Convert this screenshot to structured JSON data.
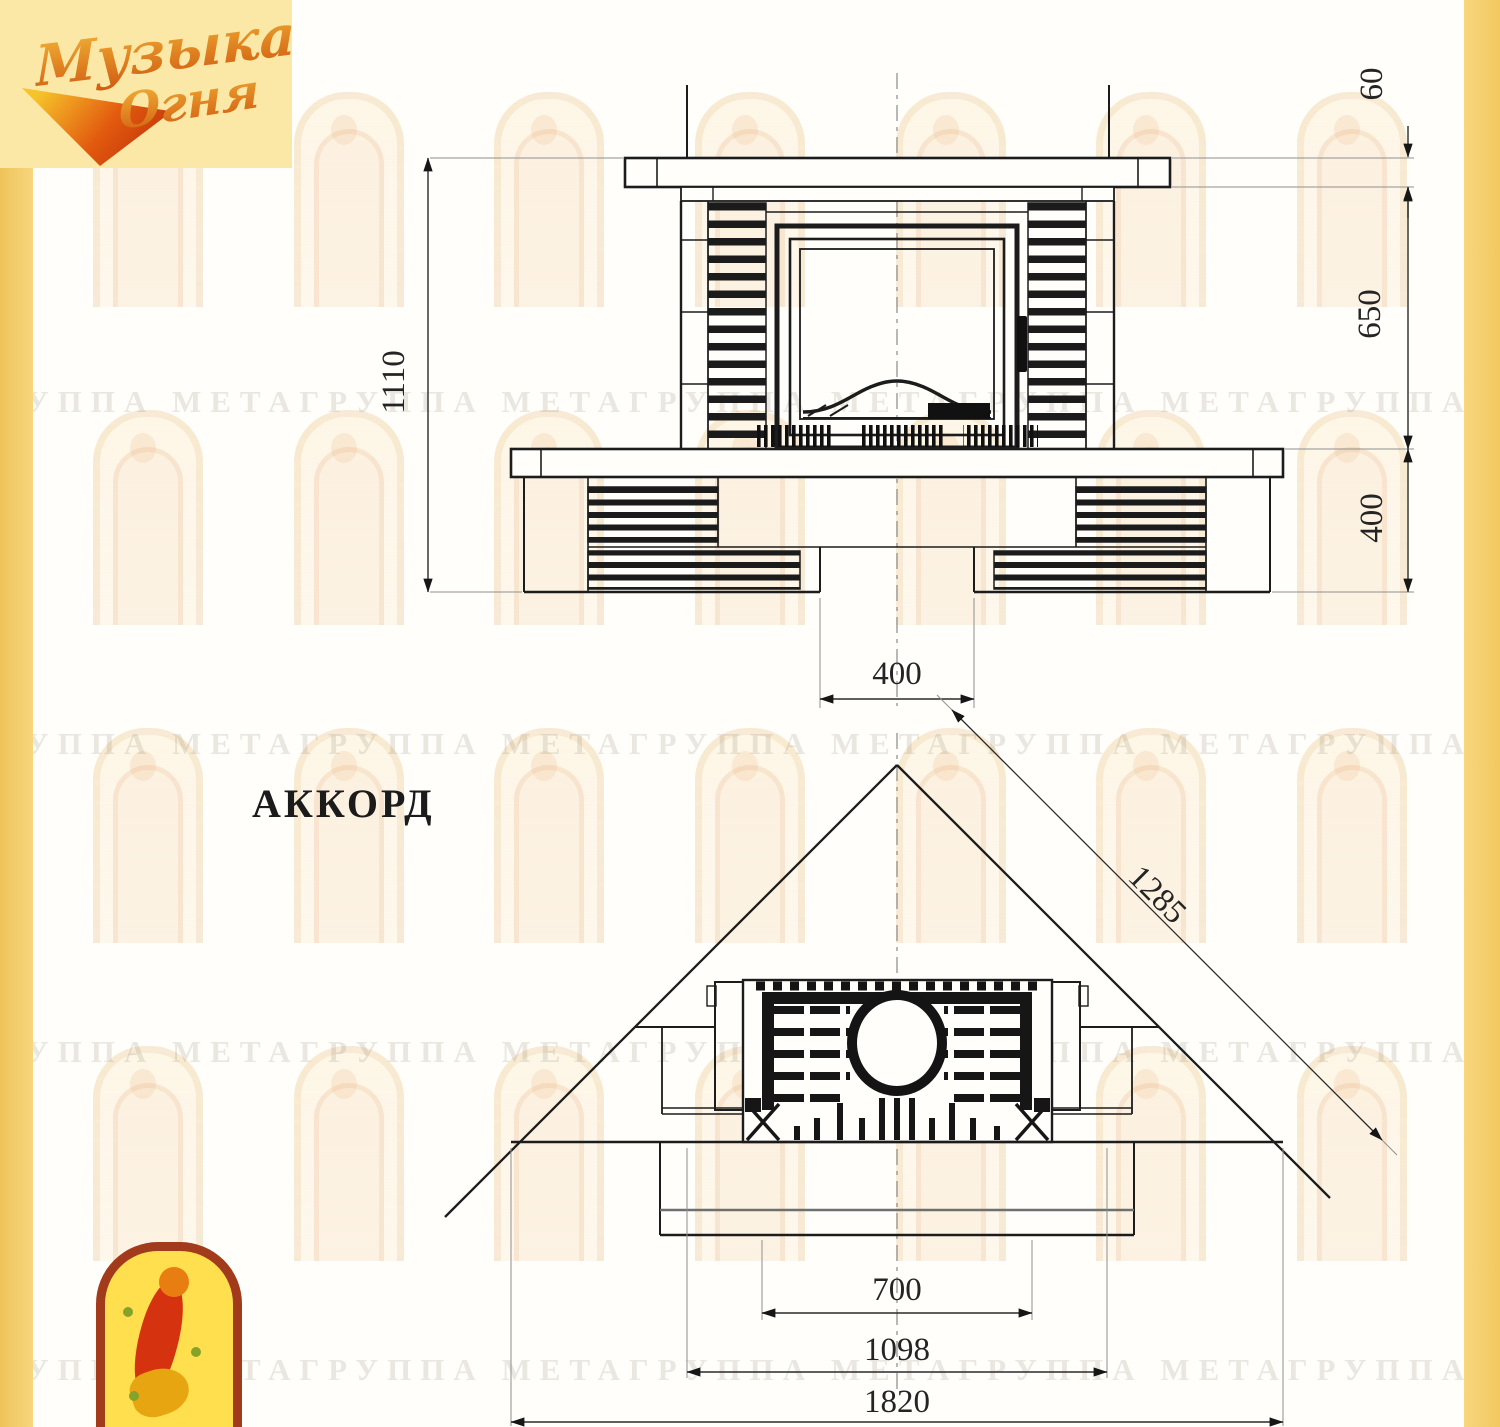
{
  "page": {
    "background": "#fffefb",
    "left_strip_color": "#f2c75f",
    "right_strip_color": "#f5cf6d",
    "line_color": "#1c1c1c",
    "dim_text_color": "#242424"
  },
  "brand_logo": {
    "word1": "Музыка",
    "word2": "Огня",
    "accent_color": "#d05a10"
  },
  "watermark": {
    "text": "ГРУППА МЕТАГРУППА МЕТАГРУППА МЕТАГРУППА МЕТАГРУППА МЕТАГРУППА МЕТА"
  },
  "drawing": {
    "title": "АККОРД",
    "front_view": {
      "dim_total_height": "1110",
      "dim_shelf_thickness": "60",
      "dim_firebox_zone": "650",
      "dim_base_height": "400",
      "dim_recess_width": "400"
    },
    "plan_view": {
      "dim_diagonal": "1285",
      "dim_firebox_width": "700",
      "dim_body_width": "1098",
      "dim_total_width": "1820"
    }
  }
}
